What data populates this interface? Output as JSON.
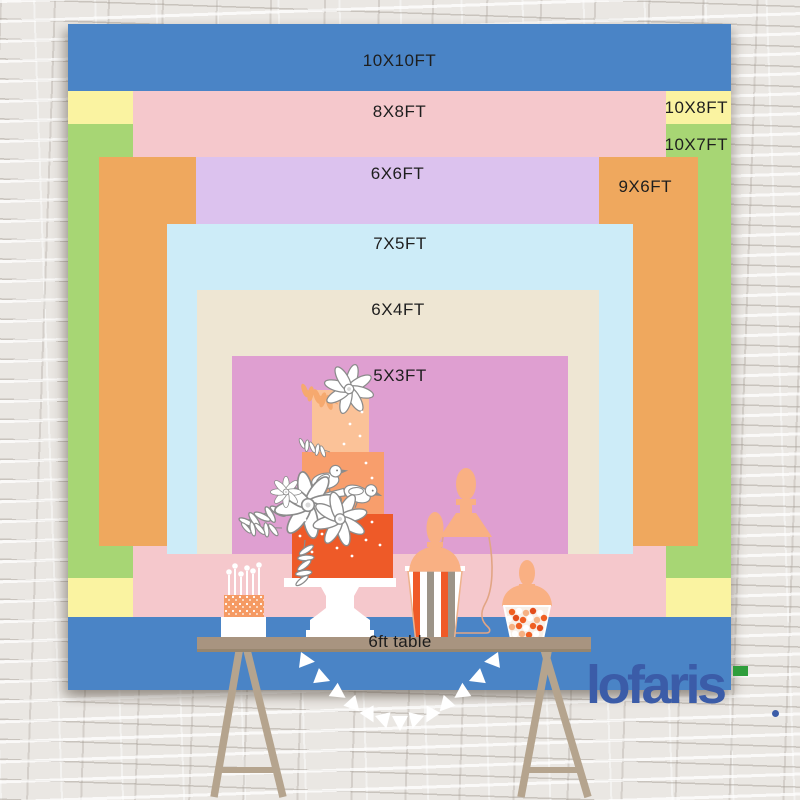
{
  "backdrop_sizes": [
    {
      "label": "10X10FT",
      "color": "#4a84c6"
    },
    {
      "label": "10X8FT",
      "color": "#faf3a1"
    },
    {
      "label": "10X7FT",
      "color": "#a7d674"
    },
    {
      "label": "8X8FT",
      "color": "#f5c8cc"
    },
    {
      "label": "9X6FT",
      "color": "#efa85e"
    },
    {
      "label": "6X6FT",
      "color": "#dcc2ee"
    },
    {
      "label": "7X5FT",
      "color": "#cdecf8"
    },
    {
      "label": "6X4FT",
      "color": "#eee6d3"
    },
    {
      "label": "5X3FT",
      "color": "#df9fd1"
    }
  ],
  "table": {
    "label": "6ft table",
    "color": "#a89480"
  },
  "brand": {
    "logo_text": "lofaris",
    "logo_color": "#3b5ca8",
    "accent_color": "#2f9e3c"
  }
}
